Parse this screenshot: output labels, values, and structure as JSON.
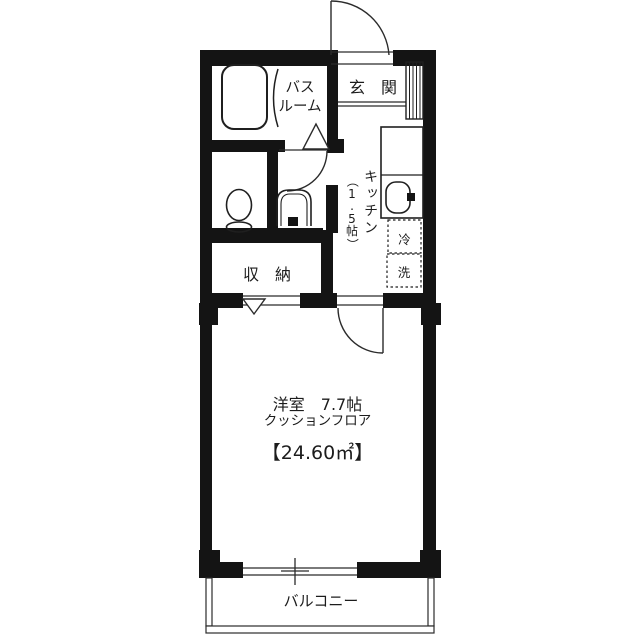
{
  "floorplan": {
    "entrance": {
      "label": "玄　関"
    },
    "bathroom": {
      "label_line1": "バス",
      "label_line2": "ルーム"
    },
    "kitchen": {
      "label": "キッチン",
      "size_vertical": [
        "（",
        "1",
        ".",
        "5",
        "帖",
        "）"
      ]
    },
    "appliances": {
      "fridge": "冷",
      "washer": "洗"
    },
    "storage": {
      "label": "収　納"
    },
    "main_room": {
      "name_size": "洋室　7.7帖",
      "floor_type": "クッションフロア",
      "area": "【24.60㎡】"
    },
    "balcony": {
      "label": "バルコニー"
    },
    "colors": {
      "wall": "#141414",
      "line": "#2b2b2b",
      "background": "#ffffff"
    }
  }
}
